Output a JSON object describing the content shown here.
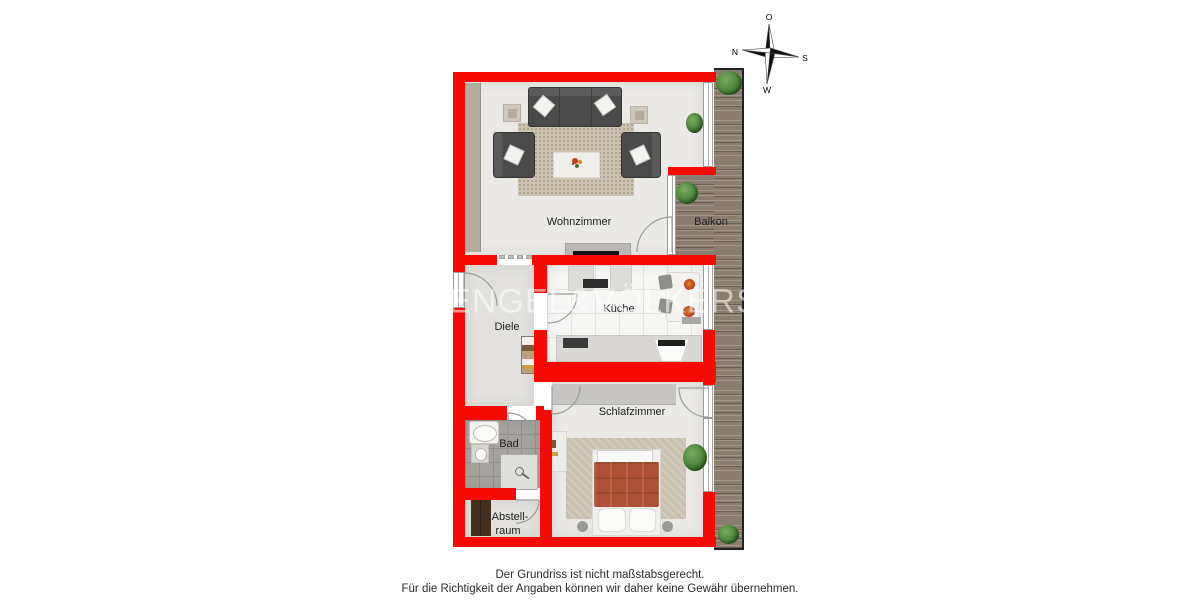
{
  "plan": {
    "labels": {
      "wohnzimmer": "Wohnzimmer",
      "balkon": "Balkon",
      "kueche": "Küche",
      "diele": "Diele",
      "schlafzimmer": "Schlafzimmer",
      "bad": "Bad",
      "abstell_line1": "Abstell-",
      "abstell_line2": "raum"
    }
  },
  "compass": {
    "o": "O",
    "n": "N",
    "s": "S",
    "w": "W"
  },
  "watermark": {
    "text": "ENGEL&VÖLKERS"
  },
  "disclaimer": {
    "line1": "Der Grundriss ist nicht maßstabsgerecht.",
    "line2": "Für die Richtigkeit der Angaben können wir daher keine Gewähr übernehmen."
  },
  "colors": {
    "wall_red": "#f50a05",
    "deck_wood": "#8a7c6e",
    "floor_light": "#eae9e6",
    "kitchen_tile": "#f6f6f4",
    "bath_tile": "#a5a29f",
    "bed_blanket": "#ad5037",
    "sofa_gray": "#4a4a4a",
    "plant_green": "#4a8438"
  }
}
